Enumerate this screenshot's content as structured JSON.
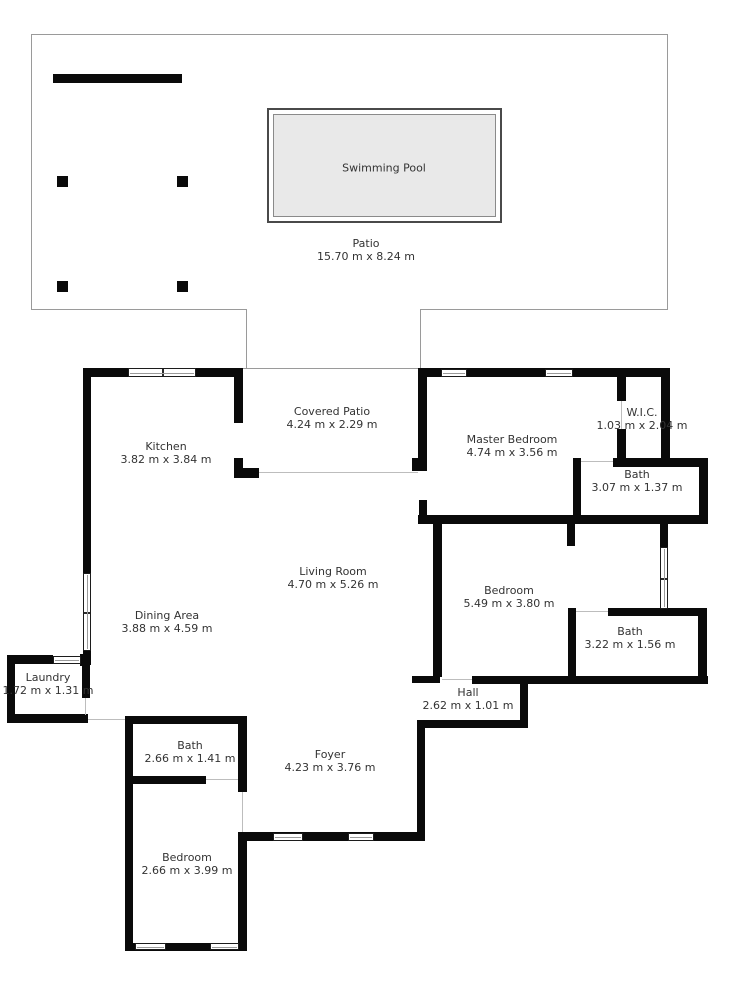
{
  "plan": {
    "type": "floor-plan",
    "units": "m"
  },
  "colors": {
    "wall": "#0a0a0a",
    "outline": "#9a9a9a",
    "pool_fill": "#e9e9e9",
    "text": "#333333"
  },
  "rooms": {
    "swimming_pool": {
      "name": "Swimming Pool",
      "dims": ""
    },
    "patio": {
      "name": "Patio",
      "dims": "15.70 m x 8.24 m"
    },
    "covered_patio": {
      "name": "Covered Patio",
      "dims": "4.24 m x 2.29 m"
    },
    "kitchen": {
      "name": "Kitchen",
      "dims": "3.82 m x 3.84 m"
    },
    "master_bedroom": {
      "name": "Master Bedroom",
      "dims": "4.74 m x 3.56 m"
    },
    "wic": {
      "name": "W.I.C.",
      "dims": "1.03 m x 2.04 m"
    },
    "master_bath": {
      "name": "Bath",
      "dims": "3.07 m x 1.37 m"
    },
    "living_room": {
      "name": "Living Room",
      "dims": "4.70 m x 5.26 m"
    },
    "dining_area": {
      "name": "Dining Area",
      "dims": "3.88 m x 4.59 m"
    },
    "bedroom_right": {
      "name": "Bedroom",
      "dims": "5.49 m x 3.80 m"
    },
    "bath_right": {
      "name": "Bath",
      "dims": "3.22 m x 1.56 m"
    },
    "laundry": {
      "name": "Laundry",
      "dims": "1.72 m x 1.31 m"
    },
    "hall": {
      "name": "Hall",
      "dims": "2.62 m x 1.01 m"
    },
    "foyer": {
      "name": "Foyer",
      "dims": "4.23 m x 3.76 m"
    },
    "bath_bottom": {
      "name": "Bath",
      "dims": "2.66 m x 1.41 m"
    },
    "bedroom_bottom": {
      "name": "Bedroom",
      "dims": "2.66 m x 3.99 m"
    }
  }
}
